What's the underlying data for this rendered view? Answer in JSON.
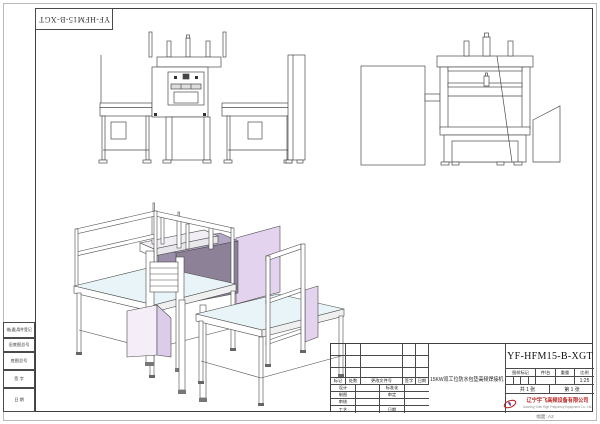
{
  "corner_stamp": {
    "text": "YF-HFM15-B-XGT"
  },
  "margin_labels": {
    "borrowed_parts": "借(通)用件登记",
    "old_original_no": "旧底图总号",
    "original_no": "底图总号",
    "signature": "签 字",
    "date": "日 期"
  },
  "title_block": {
    "product_name": "15KW双工位防水包垫高频焊接机",
    "drawing_number": "YF-HFM15-B-XGT",
    "spec_headers": {
      "mark": "图样标记",
      "per_unit": "件/台",
      "weight": "重量",
      "scale": "比例"
    },
    "scale_value": "1:25",
    "sheet_total": "共 1 张",
    "sheet_number": "第 1 张",
    "revision_header": {
      "mark": "标记",
      "count": "处数",
      "doc_no": "更改文件号",
      "sign": "签字",
      "date": "日期"
    },
    "role_rows": [
      {
        "left": "设计",
        "right": "标准化"
      },
      {
        "left": "制图",
        "right": "审定"
      },
      {
        "left": "审核",
        "right": ""
      },
      {
        "left": "工艺",
        "right": "日期"
      }
    ],
    "company": {
      "name_zh": "辽宁宇飞高频设备有限公司",
      "name_en": "Liaoning Yufei High Frequency Equipment Co., Ltd."
    },
    "paper_note": "幅面: A2"
  },
  "colors": {
    "line": "#4a4a4a",
    "lavender_panel": "#e3d3ee",
    "dark_press_block": "#8d8198",
    "table_top": "#e9f4f8",
    "company_red": "#b92a26"
  }
}
